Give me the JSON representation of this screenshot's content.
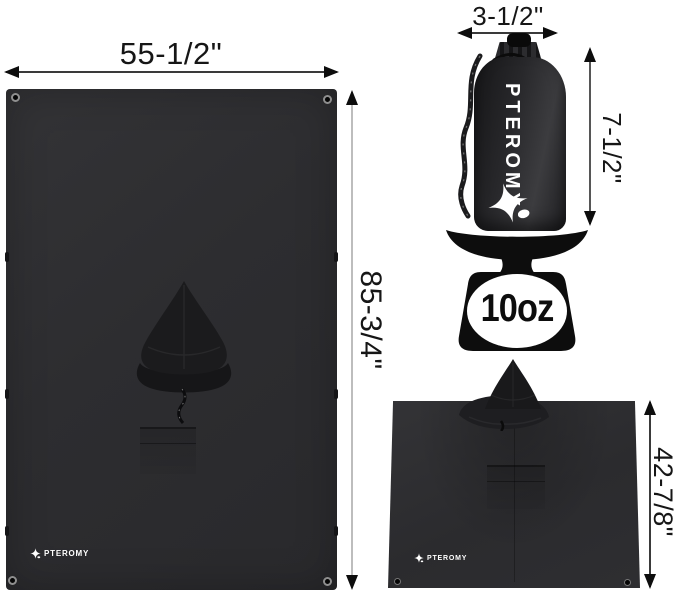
{
  "brand": "PTEROMY",
  "colors": {
    "background": "#ffffff",
    "fabric_dark": "#2d2d30",
    "fabric_darker": "#1b1b1d",
    "scale_black": "#0d0d0d",
    "dimension_text": "#161616",
    "dimension_line_dark": "#3a3a3a",
    "dimension_line_gray": "#bdbdbd",
    "logo_white": "#ffffff"
  },
  "tarp_flat": {
    "width_label": "55-1/2\"",
    "height_label": "85-3/4\"",
    "brand_label": "PTEROMY"
  },
  "stuff_sack": {
    "width_label": "3-1/2\"",
    "height_label": "7-1/2\"",
    "brand_label": "PTEROMY"
  },
  "weight_scale": {
    "weight_label": "10oz"
  },
  "poncho_worn": {
    "height_label": "42-7/8\"",
    "brand_label": "PTEROMY"
  },
  "icons": {
    "star_logo": "four-point star with blob (PTEROMY flying-squirrel mark)",
    "scale_icon": "kitchen scale silhouette",
    "arrowheads": "solid black dimension arrows"
  }
}
